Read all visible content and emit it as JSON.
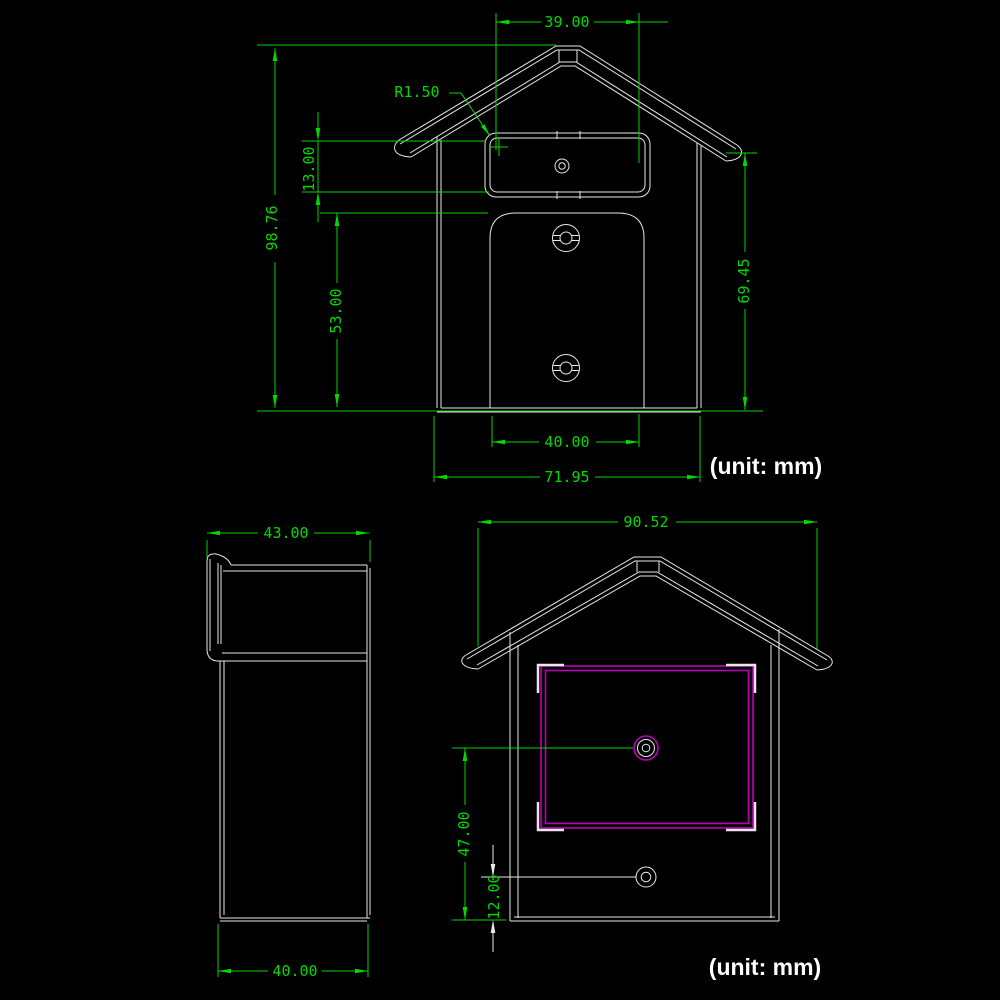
{
  "unit_note": "(unit: mm)",
  "colors": {
    "background": "#000000",
    "dimension_green": "#00d900",
    "geometry_white": "#e8e8e8",
    "highlight_magenta": "#bb00bb"
  },
  "views": {
    "front_view": {
      "dims": {
        "window_width": "39.00",
        "corner_radius": "R1.50",
        "overall_height": "98.76",
        "window_height": "13.00",
        "slot_height": "53.00",
        "side_height": "69.45",
        "slot_width": "40.00",
        "overall_width": "71.95"
      },
      "unit_note": "(unit: mm)"
    },
    "side_view": {
      "dims": {
        "overall_depth": "43.00",
        "body_depth": "40.00"
      }
    },
    "back_view": {
      "dims": {
        "overall_width": "90.52",
        "upper_hole_height": "47.00",
        "lower_hole_height": "12.00"
      },
      "unit_note": "(unit: mm)"
    }
  }
}
